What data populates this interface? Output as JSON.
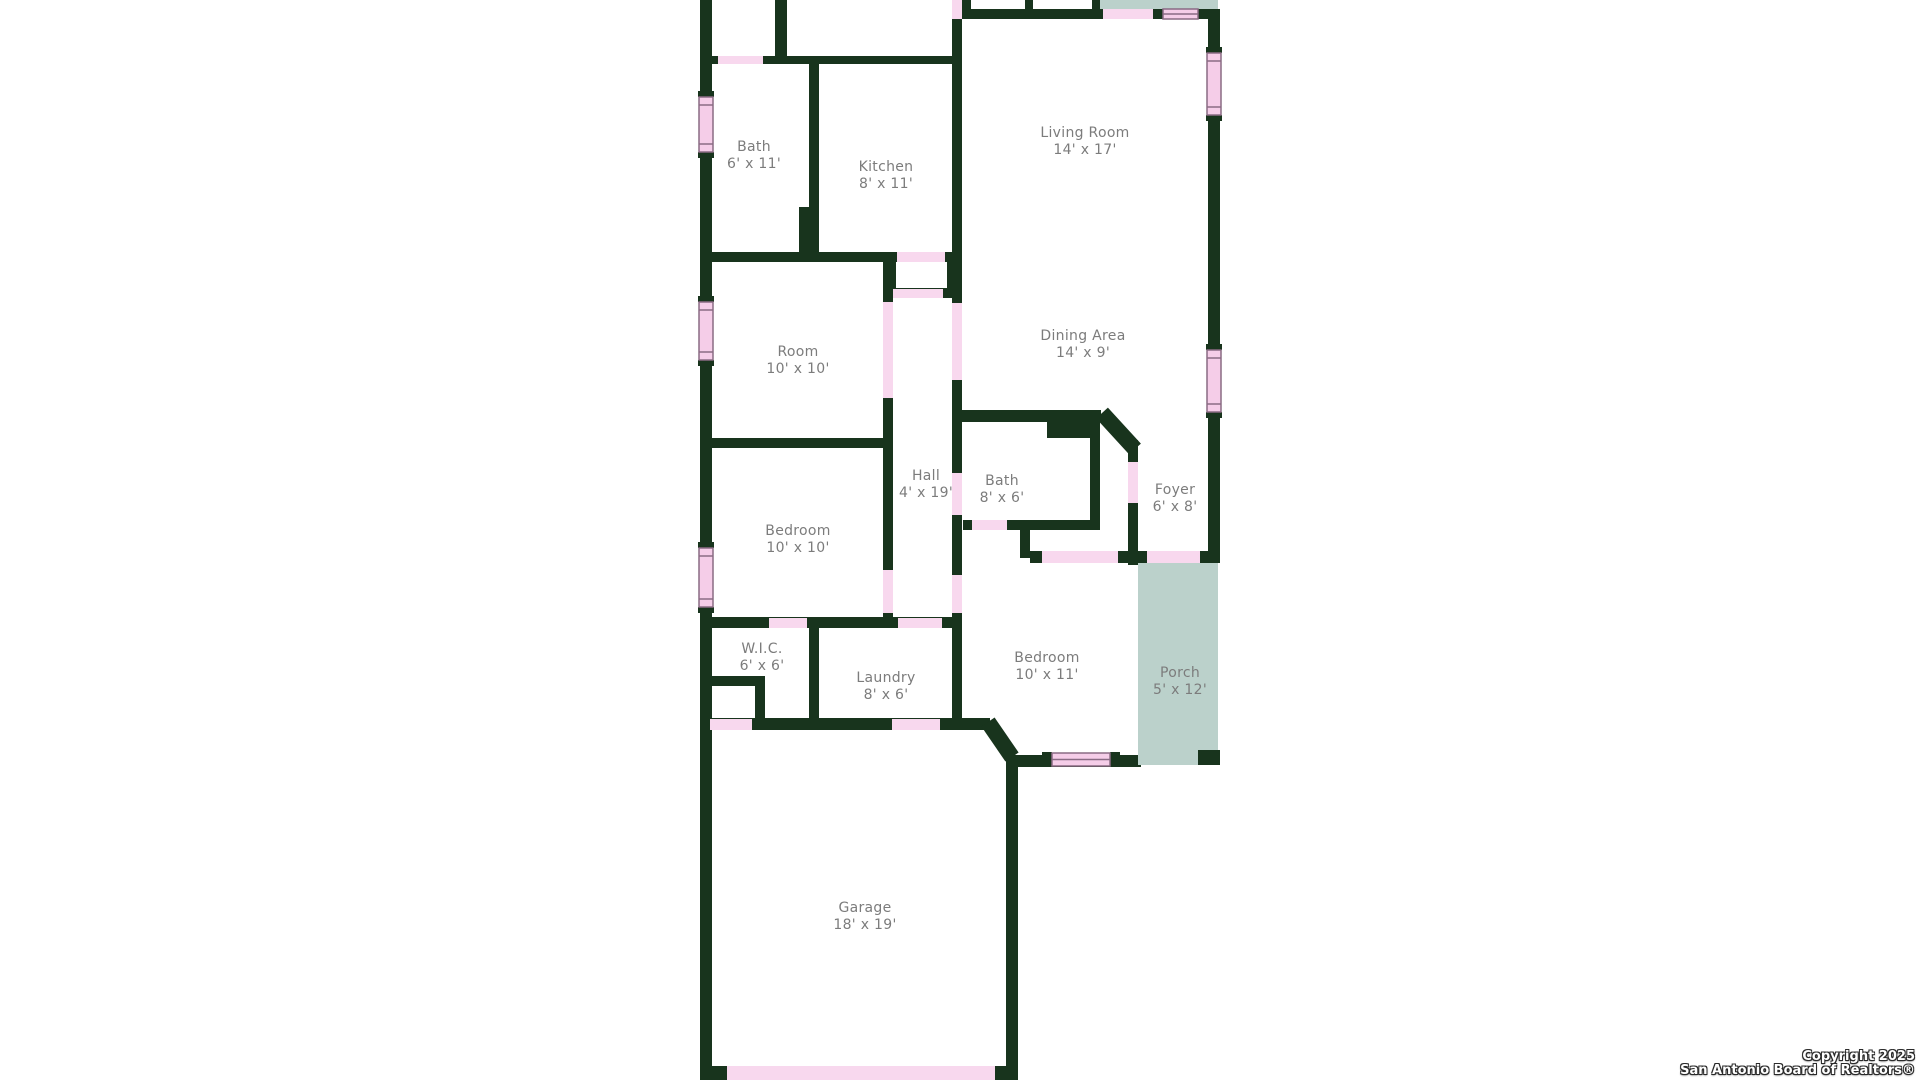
{
  "floorplan": {
    "rooms": {
      "bath1": {
        "name": "Bath",
        "dims": "6' x 11'"
      },
      "kitchen": {
        "name": "Kitchen",
        "dims": "8' x 11'"
      },
      "living": {
        "name": "Living Room",
        "dims": "14' x 17'"
      },
      "room": {
        "name": "Room",
        "dims": "10' x 10'"
      },
      "dining": {
        "name": "Dining Area",
        "dims": "14' x 9'"
      },
      "hall": {
        "name": "Hall",
        "dims": "4' x 19'"
      },
      "bath2": {
        "name": "Bath",
        "dims": "8' x 6'"
      },
      "foyer": {
        "name": "Foyer",
        "dims": "6' x 8'"
      },
      "bedroom1": {
        "name": "Bedroom",
        "dims": "10' x 10'"
      },
      "wic": {
        "name": "W.I.C.",
        "dims": "6' x 6'"
      },
      "laundry": {
        "name": "Laundry",
        "dims": "8' x 6'"
      },
      "bedroom2": {
        "name": "Bedroom",
        "dims": "10' x 11'"
      },
      "porch": {
        "name": "Porch",
        "dims": "5' x 12'"
      },
      "garage": {
        "name": "Garage",
        "dims": "18' x 19'"
      }
    },
    "colors": {
      "wall": "#18341d",
      "opening_pink": "#f8d8ee",
      "window_pink": "#f5cde8",
      "porch_teal": "#bbd1cb",
      "label_text": "#7c7c7c"
    }
  },
  "copyright": {
    "line1": "Copyright 2025",
    "line2": "San Antonio Board of Realtors®"
  }
}
